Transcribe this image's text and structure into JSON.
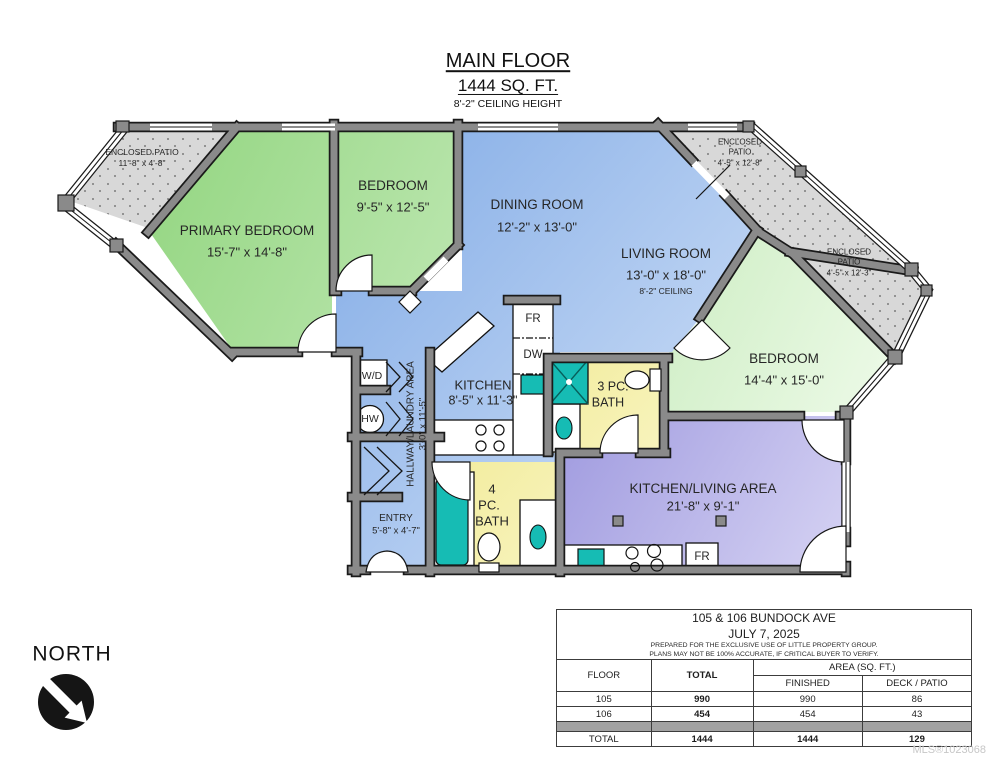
{
  "title": {
    "line1": "MAIN FLOOR",
    "line2": "1444 SQ. FT.",
    "line3": "8'-2\" CEILING HEIGHT"
  },
  "rooms": {
    "patio_nw": {
      "name": "ENCLOSED PATIO",
      "dims": "11'-8\" x 4'-8\""
    },
    "primary_bedroom": {
      "name": "PRIMARY BEDROOM",
      "dims": "15'-7\" x 14'-8\""
    },
    "bedroom_top": {
      "name": "BEDROOM",
      "dims": "9'-5\" x 12'-5\""
    },
    "dining_room": {
      "name": "DINING ROOM",
      "dims": "12'-2\" x 13'-0\""
    },
    "living_room": {
      "name": "LIVING ROOM",
      "dims": "13'-0\" x 18'-0\"",
      "note": "8'-2\" CEILING"
    },
    "patio_ne": {
      "name_l1": "ENCLOSED",
      "name_l2": "PATIO",
      "dims": "4'-5\" x 12'-8\""
    },
    "patio_e": {
      "name_l1": "ENCLOSED",
      "name_l2": "PATIO",
      "dims": "4'-5\" x 12'-3\""
    },
    "bedroom_right": {
      "name": "BEDROOM",
      "dims": "14'-4\" x 15'-0\""
    },
    "kitchen": {
      "name": "KITCHEN",
      "dims": "8'-5\" x 11'-3\""
    },
    "bath_3pc": {
      "l1": "3 PC.",
      "l2": "BATH"
    },
    "hallway": {
      "name": "HALLWAY/LAUNDRY AREA",
      "dims": "3'-0\" x 11'-5\""
    },
    "entry": {
      "name": "ENTRY",
      "dims": "5'-8\" x 4'-7\""
    },
    "bath_4pc": {
      "l1": "4",
      "l2": "PC.",
      "l3": "BATH"
    },
    "kitchen_living": {
      "name": "KITCHEN/LIVING AREA",
      "dims": "21'-8\" x 9'-1\""
    }
  },
  "fixtures": {
    "washer_dryer": "W/D",
    "hot_water": "HW",
    "fridge_kitchen": "FR",
    "dishwasher": "DW",
    "fridge_suite": "FR"
  },
  "compass": {
    "label": "NORTH"
  },
  "info_table": {
    "address": "105 & 106 BUNDOCK AVE",
    "date": "JULY 7, 2025",
    "note1": "PREPARED FOR THE EXCLUSIVE USE OF LITTLE PROPERTY GROUP.",
    "note2": "PLANS MAY NOT BE 100% ACCURATE, IF CRITICAL BUYER TO VERIFY.",
    "col_floor": "FLOOR",
    "col_total": "TOTAL",
    "col_area": "AREA (SQ. FT.)",
    "col_finished": "FINISHED",
    "col_deck": "DECK / PATIO",
    "rows": [
      {
        "floor": "105",
        "total": "990",
        "finished": "990",
        "deck": "86"
      },
      {
        "floor": "106",
        "total": "454",
        "finished": "454",
        "deck": "43"
      }
    ],
    "total_row": {
      "floor": "TOTAL",
      "total": "1444",
      "finished": "1444",
      "deck": "129"
    }
  },
  "watermark": "MLS®1023068",
  "colors": {
    "wall": "#8a8a8a",
    "wall_outline": "#1a1a1a",
    "bedroom_green": "#9bd989",
    "living_blue": "#8db3e8",
    "bath_yellow": "#f2ec98",
    "suite_purple": "#a8a3e0",
    "patio_gray": "#d8d8d8",
    "fixture_teal": "#16bcb4"
  }
}
